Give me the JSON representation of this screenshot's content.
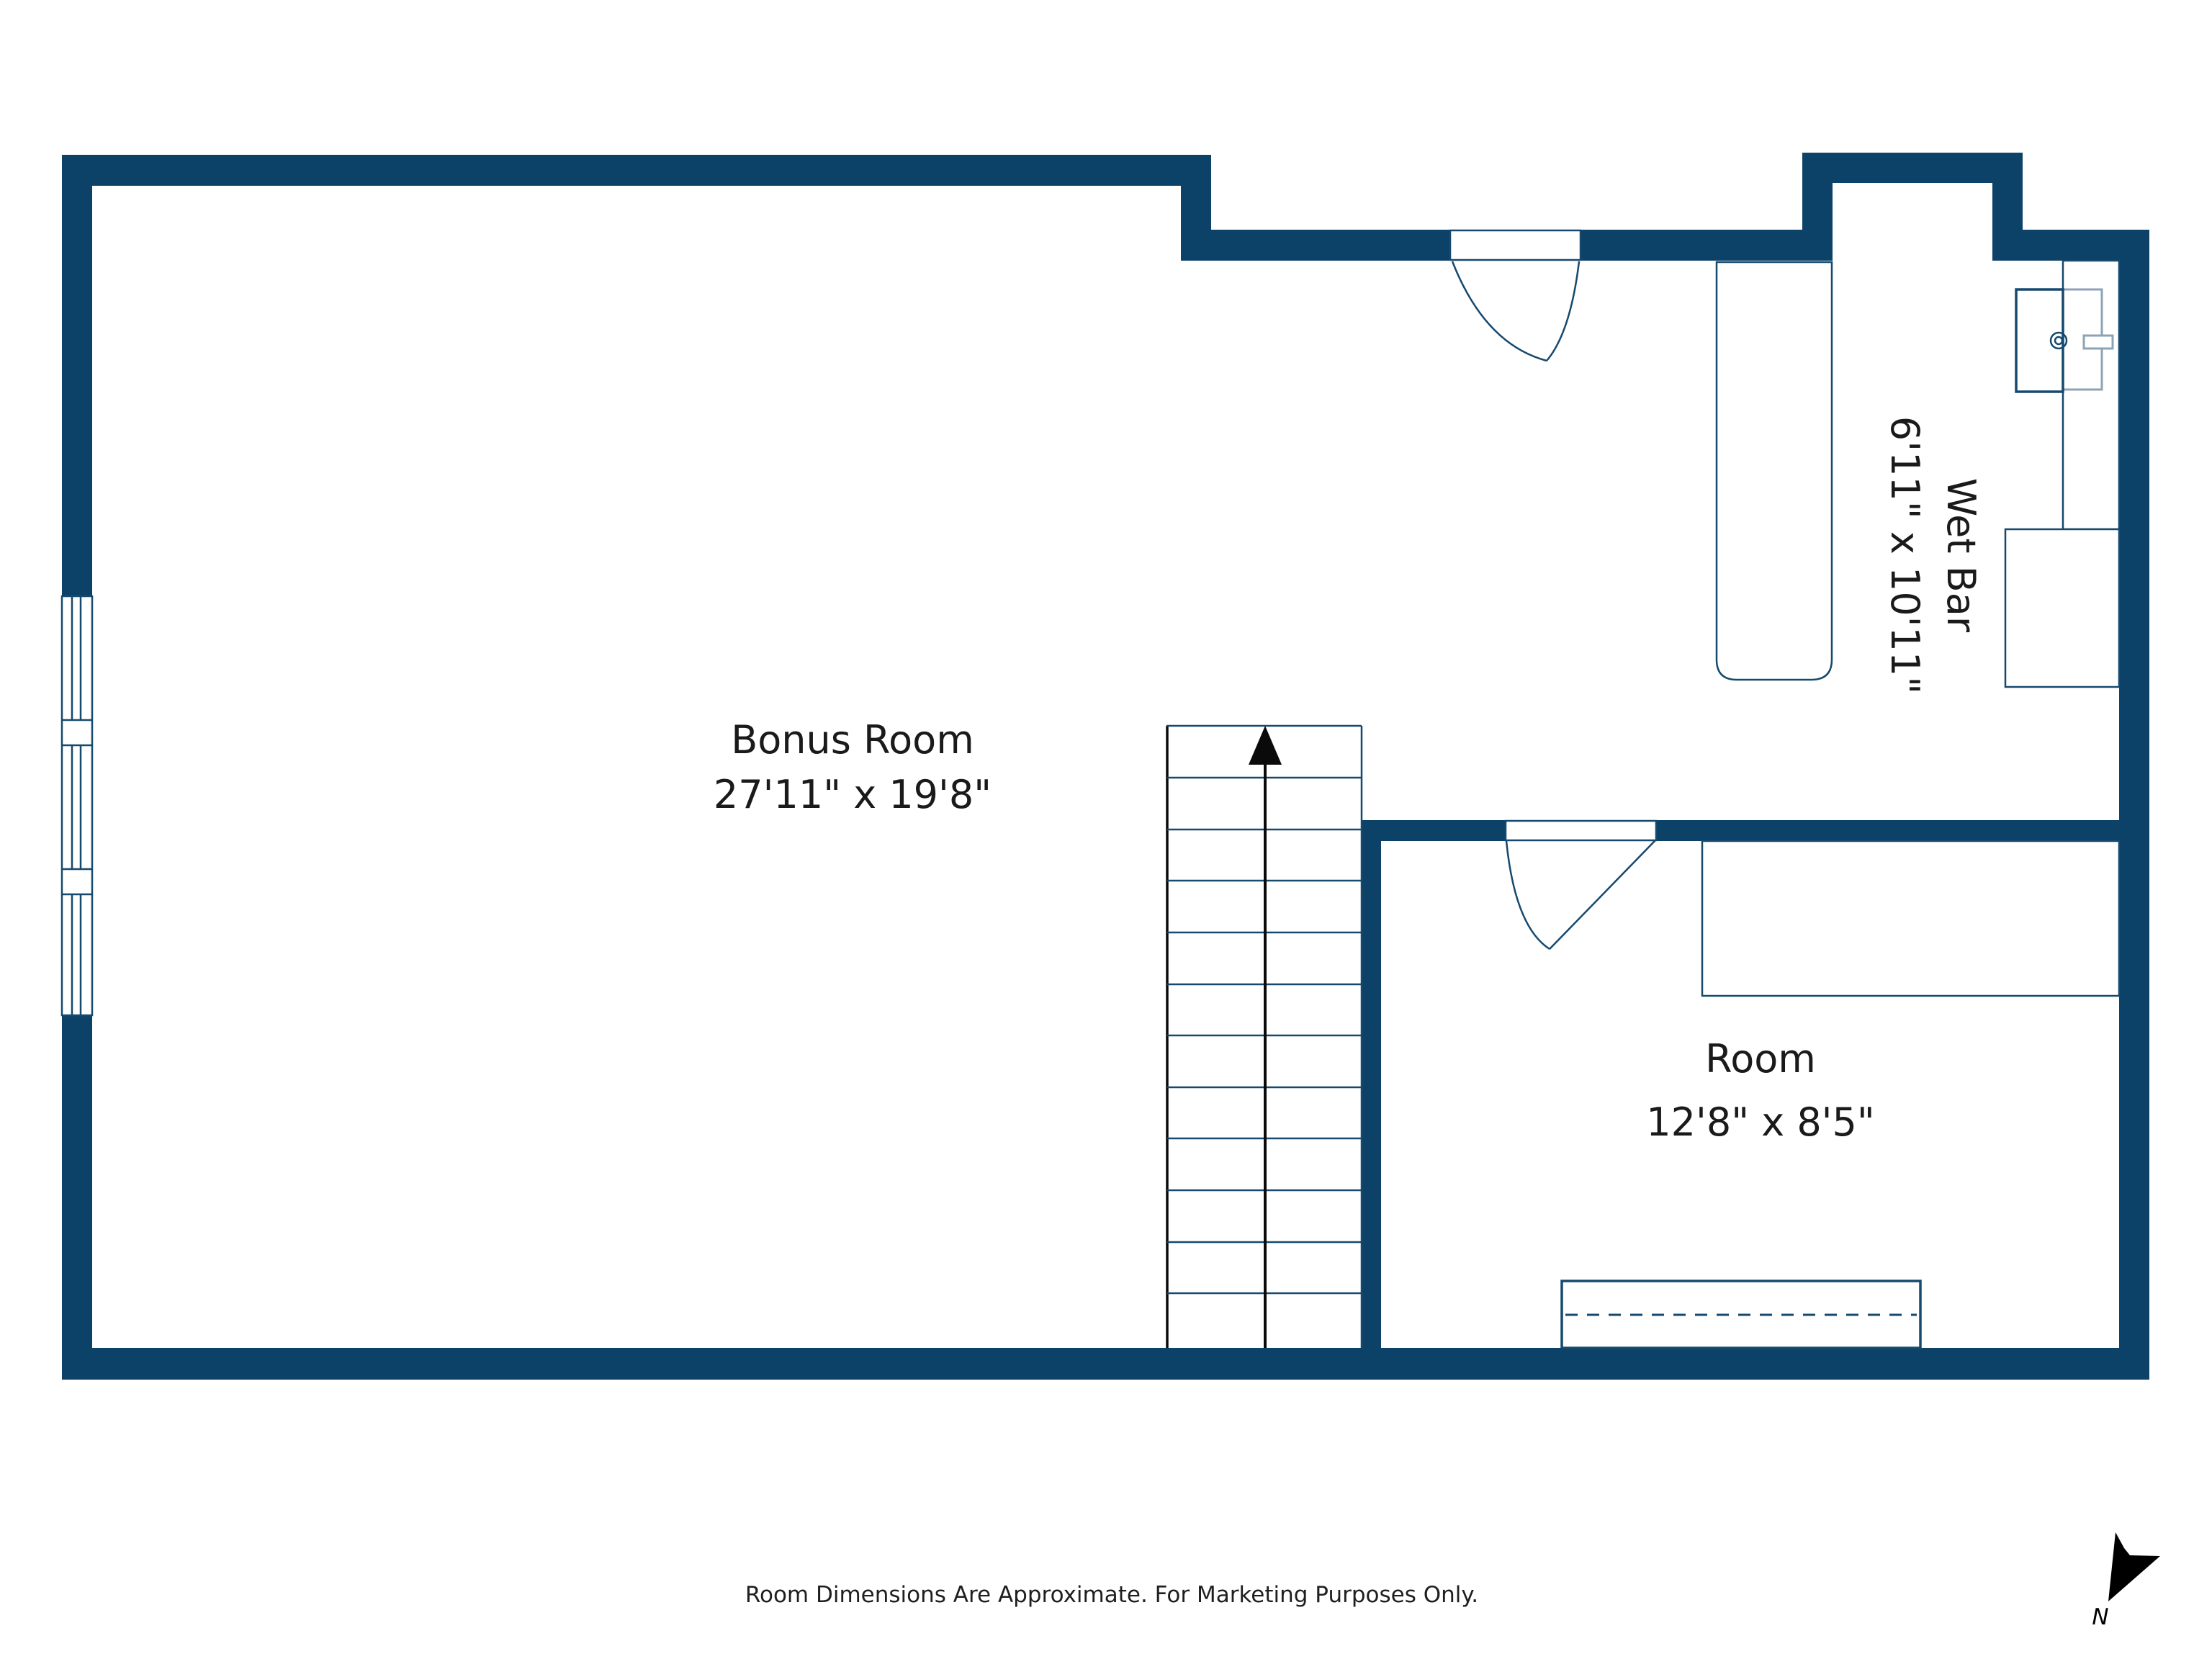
{
  "floor_plan": {
    "rooms": [
      {
        "id": "bonus-room",
        "name": "Bonus Room",
        "dimensions": "27'11\" x 19'8\""
      },
      {
        "id": "wet-bar",
        "name": "Wet Bar",
        "dimensions": "6'11\" x 10'11\""
      },
      {
        "id": "room",
        "name": "Room",
        "dimensions": "12'8\" x 8'5\""
      }
    ],
    "footer_note": "Room Dimensions Are Approximate. For Marketing Purposes Only.",
    "compass_label": "N",
    "colors": {
      "wall": "#0d4268",
      "line": "#16496e",
      "cabinet_light": "#8ca3b5",
      "text": "#1a1a1a",
      "arrow_black": "#0a0a0a"
    }
  }
}
